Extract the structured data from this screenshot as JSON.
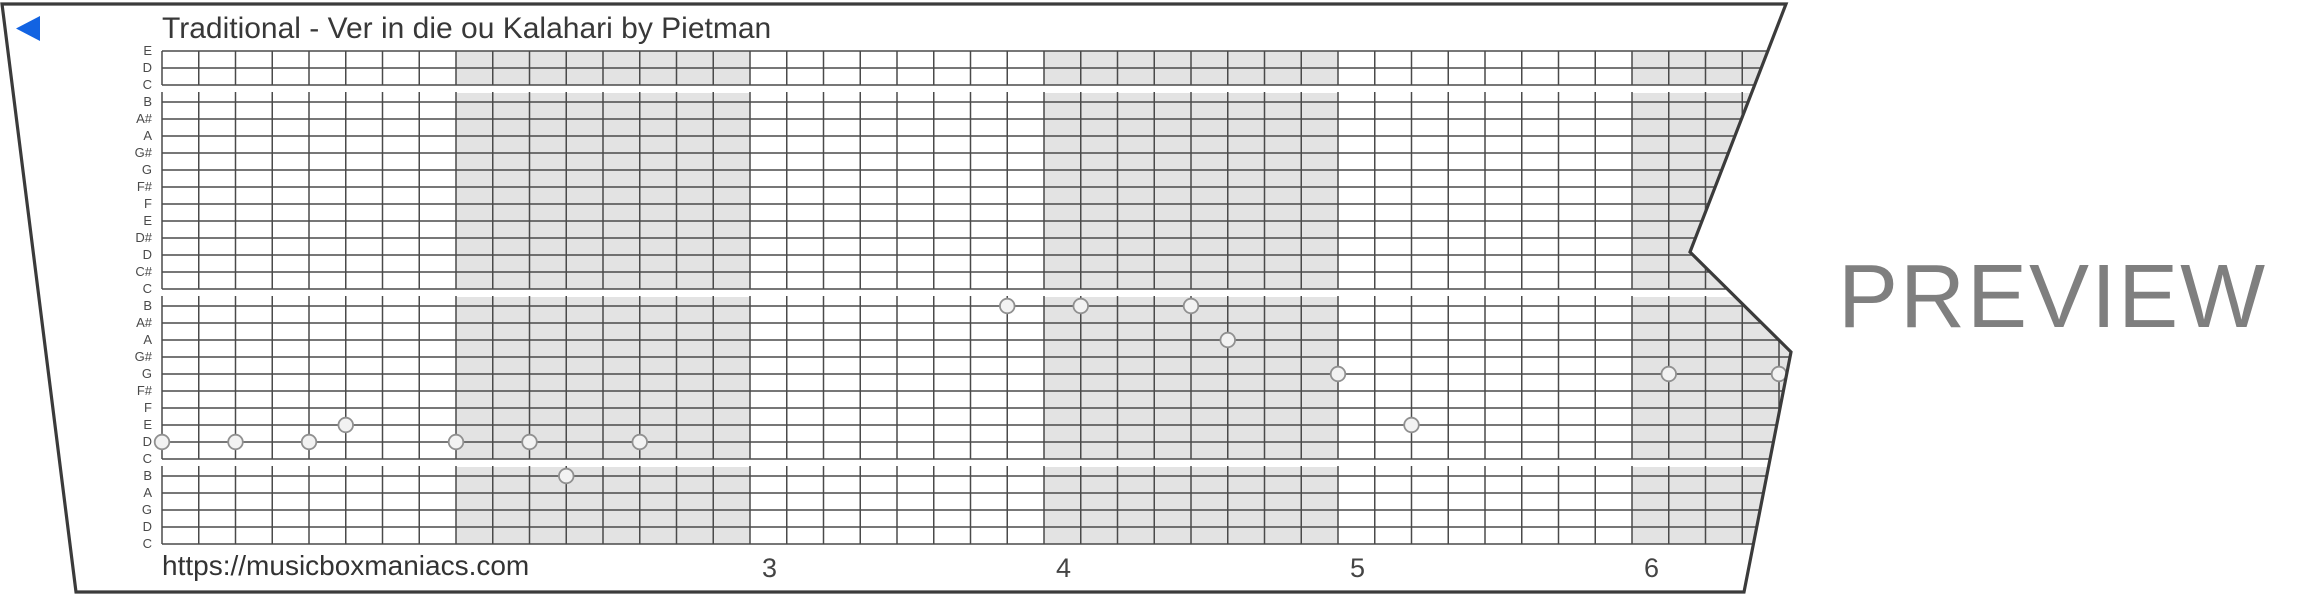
{
  "title": "Traditional - Ver in die ou Kalahari by Pietman",
  "url_label": "https://musicboxmaniacs.com",
  "preview_watermark": "PREVIEW",
  "strip": {
    "note_labels": [
      "E",
      "D",
      "C",
      "B",
      "A#",
      "A",
      "G#",
      "G",
      "F#",
      "F",
      "E",
      "D#",
      "D",
      "C#",
      "C",
      "B",
      "A#",
      "A",
      "G#",
      "G",
      "F#",
      "F",
      "E",
      "D",
      "C",
      "B",
      "A",
      "G",
      "D",
      "C"
    ],
    "sections": [
      [
        0,
        2
      ],
      [
        3,
        14
      ],
      [
        15,
        24
      ],
      [
        25,
        29
      ]
    ],
    "measure_numbers": [
      {
        "label": "3",
        "measure_index": 2
      },
      {
        "label": "4",
        "measure_index": 3
      },
      {
        "label": "5",
        "measure_index": 4
      },
      {
        "label": "6",
        "measure_index": 5
      }
    ],
    "shaded_measures": [
      1,
      3,
      5
    ],
    "notes": [
      {
        "col": 0,
        "row": 23,
        "pitch": "D"
      },
      {
        "col": 2,
        "row": 23,
        "pitch": "D"
      },
      {
        "col": 4,
        "row": 23,
        "pitch": "D"
      },
      {
        "col": 5,
        "row": 22,
        "pitch": "E"
      },
      {
        "col": 8,
        "row": 23,
        "pitch": "D"
      },
      {
        "col": 10,
        "row": 23,
        "pitch": "D"
      },
      {
        "col": 11,
        "row": 25,
        "pitch": "B"
      },
      {
        "col": 13,
        "row": 23,
        "pitch": "D"
      },
      {
        "col": 23,
        "row": 15,
        "pitch": "B"
      },
      {
        "col": 25,
        "row": 15,
        "pitch": "B"
      },
      {
        "col": 28,
        "row": 15,
        "pitch": "B"
      },
      {
        "col": 29,
        "row": 17,
        "pitch": "A"
      },
      {
        "col": 32,
        "row": 19,
        "pitch": "G"
      },
      {
        "col": 34,
        "row": 22,
        "pitch": "E"
      },
      {
        "col": 41,
        "row": 19,
        "pitch": "G"
      },
      {
        "col": 44,
        "row": 19,
        "pitch": "G"
      }
    ],
    "geometry": {
      "grid_x": 162,
      "col_width": 36.75,
      "cols_per_measure": 8,
      "num_cols": 48,
      "first_line_y": 51,
      "row_height": 17,
      "gap_stub": 10,
      "note_radius": 7.3,
      "label_right_x": 152
    },
    "paper_polygon": [
      [
        2,
        4
      ],
      [
        1786,
        4
      ],
      [
        1690,
        252
      ],
      [
        1791,
        352
      ],
      [
        1744,
        592
      ],
      [
        76,
        592
      ]
    ],
    "colors": {
      "shade": "#e3e3e3",
      "grid_line": "#4a4a4a",
      "outline": "#3b3b3b",
      "note_fill": "#f2f2f2",
      "note_border": "#909090",
      "back_arrow": "#1263e2"
    }
  }
}
